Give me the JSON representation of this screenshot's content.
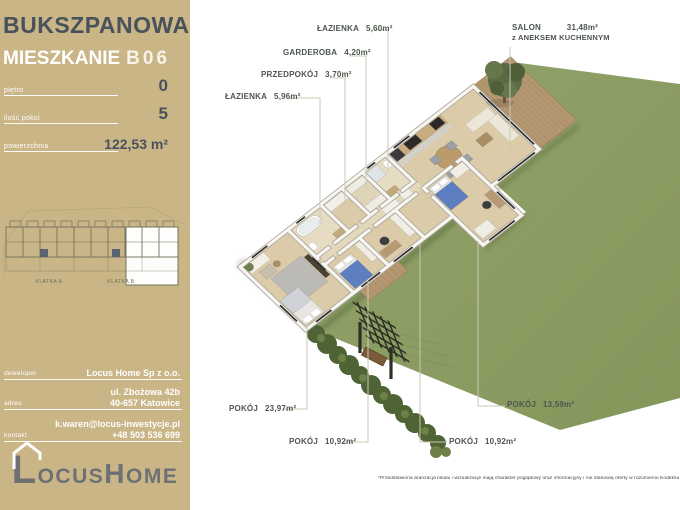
{
  "colors": {
    "sidebar_bg": "#c9b586",
    "title_dark": "#49525b",
    "garden_green": "#8c9c63",
    "hedge_green": "#4f6434",
    "floor_tan": "#dbcba8",
    "deck_brown": "#b49771",
    "bed_blue": "#5d7ec0",
    "label_text": "#4d564e",
    "logo_gray": "#6e7174"
  },
  "sidebar": {
    "project": "BUKSZPANOWA",
    "unit_label": "MIESZKANIE",
    "unit_number": "B06",
    "specs": [
      {
        "label": "piętro",
        "value": "0"
      },
      {
        "label": "ilość pokoi",
        "value": "5"
      },
      {
        "label": "powierzchnia",
        "value": "122,53 m²"
      }
    ],
    "minimap": {
      "stairwell_a": "KLATKA A",
      "stairwell_b": "KLATKA B"
    },
    "contact": [
      {
        "label": "deweloper",
        "lines": [
          "Locus Home Sp z o.o."
        ]
      },
      {
        "label": "adres",
        "lines": [
          "ul. Zbożowa 42b",
          "40-657 Katowice"
        ]
      },
      {
        "label": "kontakt",
        "lines": [
          "k.waren@locus-inwestycje.pl",
          "+48 503 536 699"
        ]
      }
    ],
    "logo": {
      "l": "L",
      "rest1": "OCUS",
      "h": "H",
      "rest2": "OME"
    }
  },
  "plan": {
    "rooms": [
      {
        "name": "ŁAZIENKA",
        "area": "5,60m²"
      },
      {
        "name": "GARDEROBA",
        "area": "4,20m²"
      },
      {
        "name": "PRZEDPOKÓJ",
        "area": "3,70m²"
      },
      {
        "name": "ŁAZIENKA",
        "area": "5,96m²"
      },
      {
        "name": "SALON",
        "area": "31,48m²",
        "sub": "z ANEKSEM KUCHENNYM"
      },
      {
        "name": "POKÓJ",
        "area": "23,97m²"
      },
      {
        "name": "POKÓJ",
        "area": "10,92m²"
      },
      {
        "name": "POKÓJ",
        "area": "10,92m²"
      },
      {
        "name": "POKÓJ",
        "area": "13,59m²"
      }
    ]
  },
  "footer": {
    "disclaimer": "*Przedstawiona aranżacja lokalu i wizualizacje mają charakter poglądowy oraz informacyjny i nie stanowią oferty w rozumieniu Kodeksu Cywilnego"
  }
}
